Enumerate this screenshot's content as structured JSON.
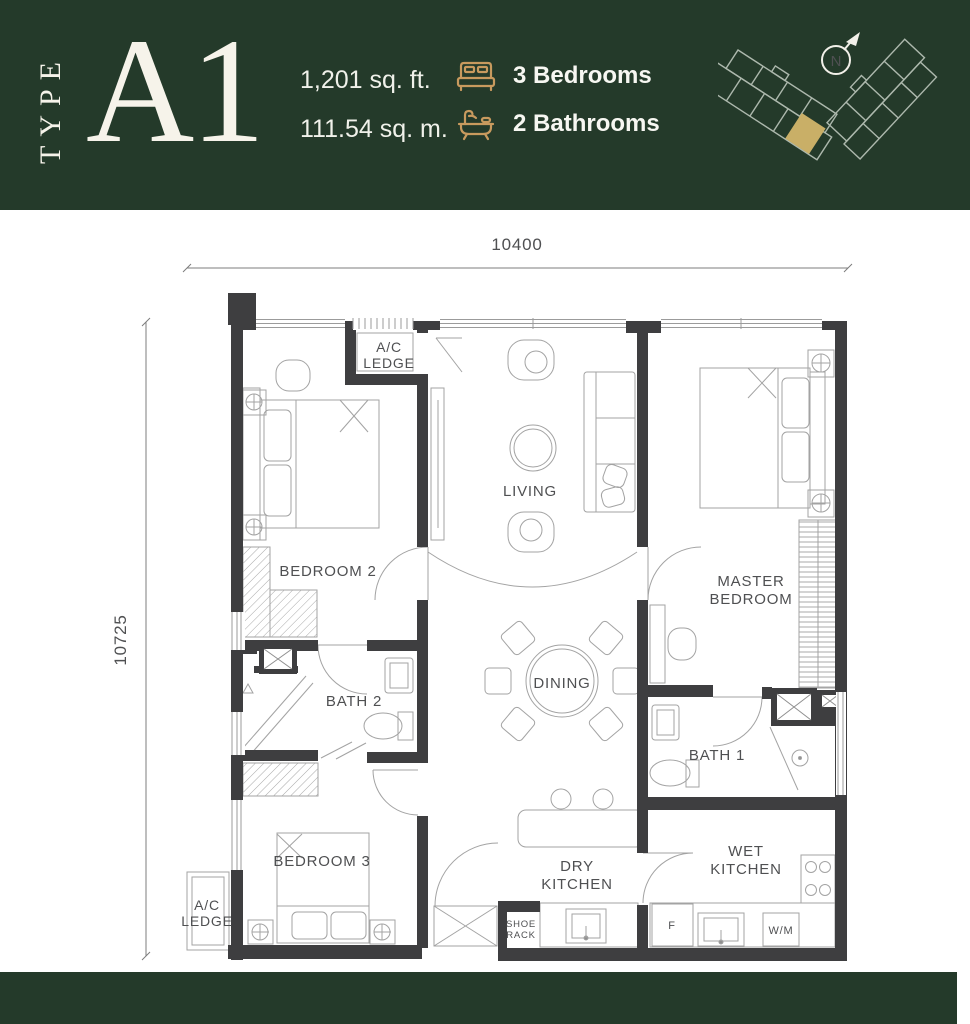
{
  "header": {
    "type_label": "TYPE",
    "unit_code": "A1",
    "area_sqft": "1,201 sq. ft.",
    "area_sqm": "111.54 sq. m.",
    "bedrooms": "3 Bedrooms",
    "bathrooms": "2 Bathrooms",
    "compass_n": "N"
  },
  "colors": {
    "brand_green": "#243a2a",
    "accent_gold": "#c89a5e",
    "highlight_unit": "#e6c472",
    "wall": "#3e3e40",
    "thin_line": "#a3a3a3"
  },
  "plan": {
    "dim_width": "10400",
    "dim_height": "10725",
    "labels": {
      "ac_l1": "A/C",
      "ac_l2": "LEDGE",
      "bedroom2": "BEDROOM 2",
      "living": "LIVING",
      "master_l1": "MASTER",
      "master_l2": "BEDROOM",
      "bath2": "BATH 2",
      "dining": "DINING",
      "bath1": "BATH 1",
      "bedroom3": "BEDROOM 3",
      "dry_l1": "DRY",
      "dry_l2": "KITCHEN",
      "wet_l1": "WET",
      "wet_l2": "KITCHEN",
      "shoe_l1": "SHOE",
      "shoe_l2": "RACK",
      "fridge": "F",
      "washer": "W/M"
    }
  }
}
